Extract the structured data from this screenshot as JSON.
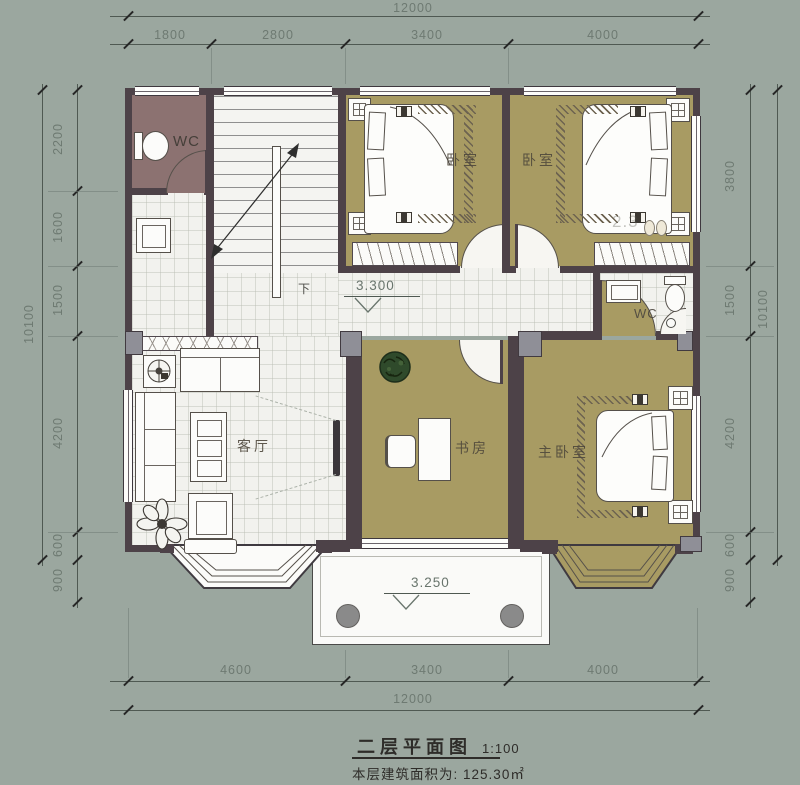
{
  "colors": {
    "background": "#9ba79f",
    "wall": "#4d4248",
    "floor_tile": "#f2f2ee",
    "floor_khaki": "#a89b63",
    "floor_wc": "#8c7271",
    "balcony_white": "#fafaf8",
    "dim_text": "#6e7a72",
    "column_gray": "#8f8f97",
    "plant_green": "#2f4a2b"
  },
  "dims": {
    "top": {
      "total": "12000",
      "segments": [
        "1800",
        "2800",
        "3400",
        "4000"
      ]
    },
    "bottom": {
      "total": "12000",
      "segments": [
        "4600",
        "3400",
        "4000"
      ]
    },
    "left": {
      "total": "10100",
      "segments": [
        "2200",
        "1600",
        "1500",
        "4200",
        "600",
        "900"
      ]
    },
    "right": {
      "total": "10100",
      "segments": [
        "3800",
        "1500",
        "4200",
        "600",
        "900"
      ]
    }
  },
  "rooms": {
    "wc1": "WC",
    "bedroom1": "卧室",
    "bedroom2": "卧室",
    "wc2": "WC",
    "living": "客厅",
    "study": "书房",
    "master": "主卧室"
  },
  "levels": {
    "hall": "3.300",
    "balcony": "3.250"
  },
  "stairs": {
    "down_label": "下"
  },
  "annotations": {
    "faint_number": "2.3"
  },
  "title": {
    "name": "二层平面图",
    "scale": "1:100",
    "area_label": "本层建筑面积为:",
    "area_value": "125.30㎡"
  }
}
